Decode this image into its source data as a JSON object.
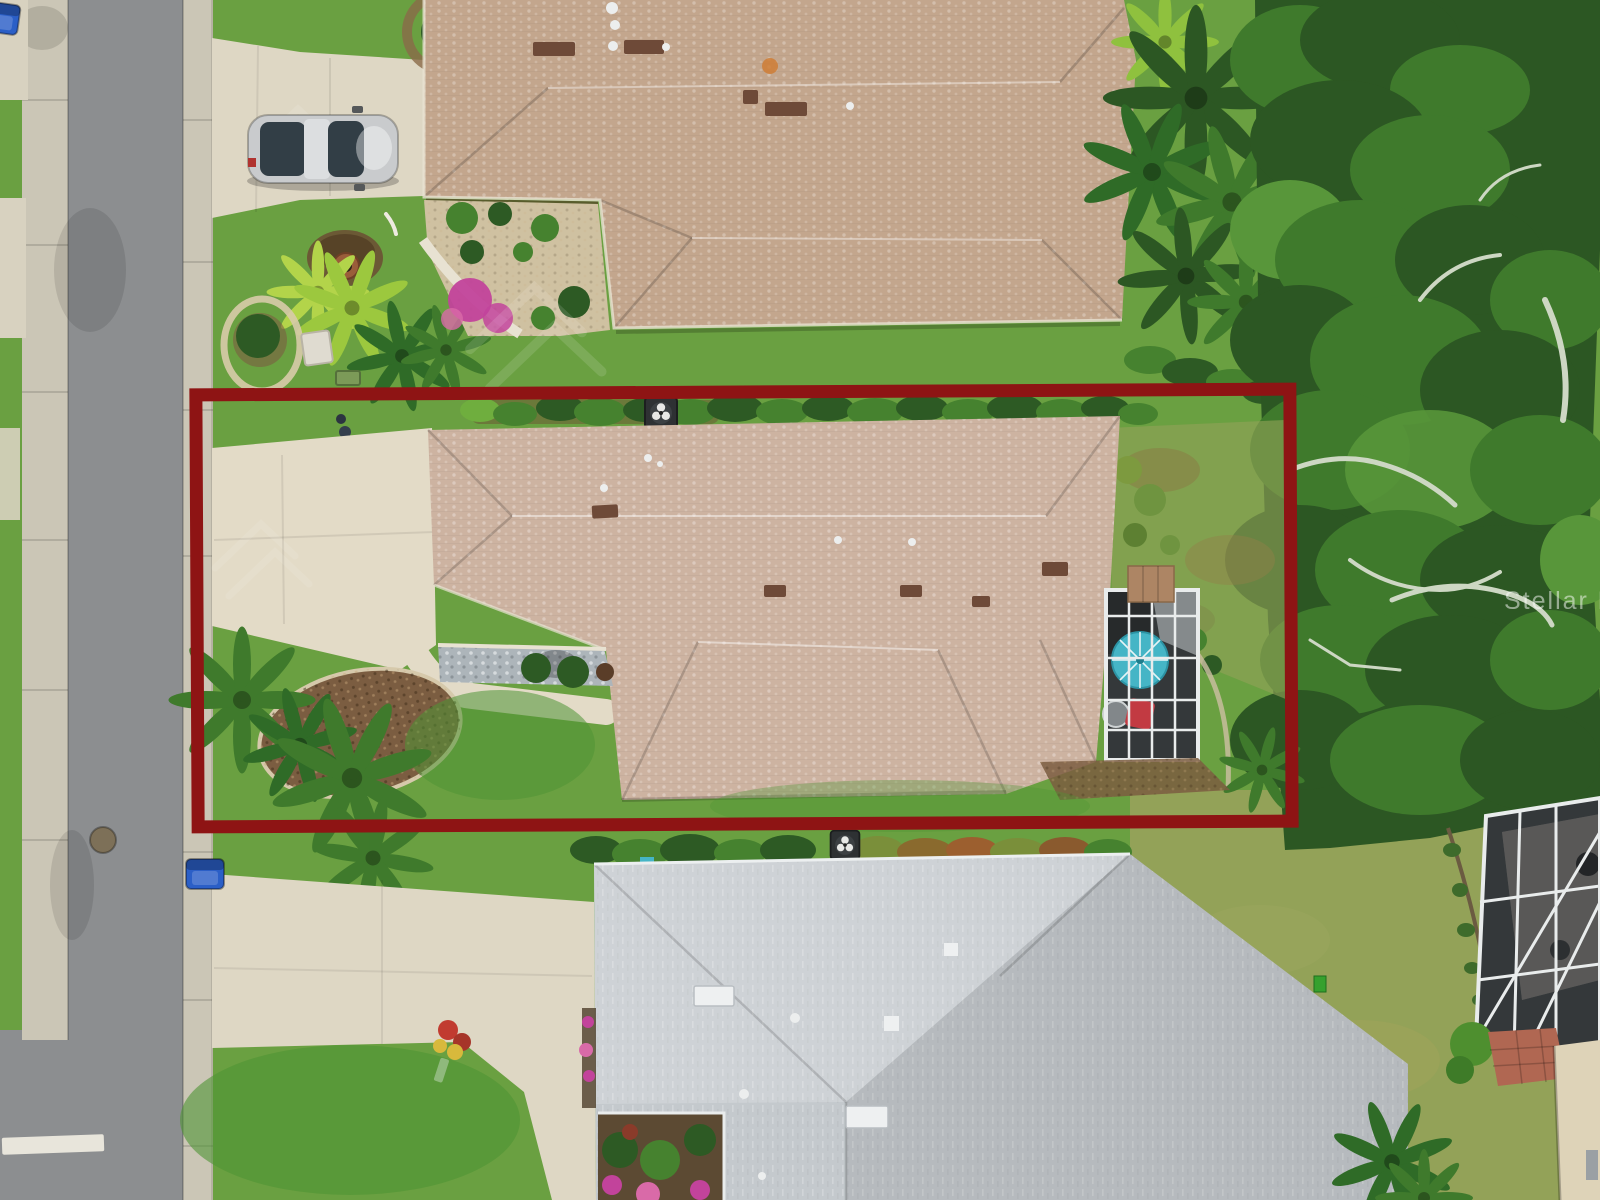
{
  "meta": {
    "description": "Aerial drone photograph of a single-family home lot outlined with a red property-boundary rectangle, listing photo style",
    "image_type": "real-estate aerial photograph"
  },
  "watermark": {
    "text": "Stellar MLS"
  },
  "boundary": {
    "label": "property boundary outline",
    "color": "#8e1414",
    "stroke_px": 13
  },
  "scene": {
    "features": [
      {
        "id": "street",
        "label": "asphalt street with concrete gutters along left side"
      },
      {
        "id": "stop-line",
        "label": "white painted stop bar at bottom of street"
      },
      {
        "id": "manhole",
        "label": "round manhole cover in street"
      },
      {
        "id": "trash-bins",
        "label": "three blue curbside bins"
      },
      {
        "id": "parked-car",
        "label": "silver sedan parked on north neighbor driveway"
      },
      {
        "id": "north-house",
        "label": "tan shingle hip-roof house at top"
      },
      {
        "id": "subject-house",
        "label": "tan shingle hip-roof house inside red boundary"
      },
      {
        "id": "subject-pool-enclosure",
        "label": "screened lanai with teal patio umbrella, red chair and round table"
      },
      {
        "id": "south-house",
        "label": "light gray shingle hip-roof house at bottom"
      },
      {
        "id": "northeast-house",
        "label": "slate-roof house with brick paver patio, top right"
      },
      {
        "id": "southeast-pool-cage",
        "label": "white-framed screened pool cage, bottom right"
      },
      {
        "id": "tree-canopy",
        "label": "dense oak tree canopy along right side"
      },
      {
        "id": "landscaping",
        "label": "palms, mulch beds, hedges and flowering shrubs"
      }
    ]
  },
  "colors": {
    "asphalt": "#8c8e90",
    "gutter": "#cbc6b6",
    "concrete": "#d8d2c0",
    "driveway": "#ded7c4",
    "drivewaySubject": "#e3dbc7",
    "grassBase": "#6aa041",
    "grassBright": "#4e9434",
    "grassDry": "#93a258",
    "hedgeDark": "#2d5a24",
    "hedgeMid": "#46822f",
    "hedgeLight": "#6fae3e",
    "limePlant": "#9cc83e",
    "treeDark": "#2c5723",
    "treeMid": "#3f7a2c",
    "treeLight": "#58963a",
    "branch": "#cdd7c3",
    "roofTanNorth": "#c3a68d",
    "roofTanSubject": "#cdb3a1",
    "roofGraySouth": "#c4c9cd",
    "roofSlateNE": "#646b72",
    "ventBrown": "#6e4a38",
    "pipeWhite": "#eceeee",
    "mulch": "#7b5d41",
    "gravelBlue": "#adb5ba",
    "gravelTan": "#cfc1a1",
    "stoneRing": "#d8cbaa",
    "paverBrown": "#ad8564",
    "paverRed": "#b06752",
    "enclosureDark": "#34383a",
    "frameWhite": "#e9ecec",
    "umbrellaTeal": "#45b5c6",
    "chairRed": "#c23a42",
    "tableGray": "#82878a",
    "binBlue": "#2b5fc7",
    "carBody": "#c9cbcd",
    "carGlass": "#323e46",
    "wallCream": "#ded3b8",
    "soil": "#6b5134",
    "potTerracotta": "#9a5d3a",
    "flowerMagenta": "#c2439b",
    "flowerRed": "#c13b30",
    "flowerYellow": "#d8b93c",
    "boundaryRed": "#8e1414",
    "pathWhite": "#e8e2d2",
    "stopLineWhite": "#f0ede2",
    "manhole": "#7d7058"
  }
}
